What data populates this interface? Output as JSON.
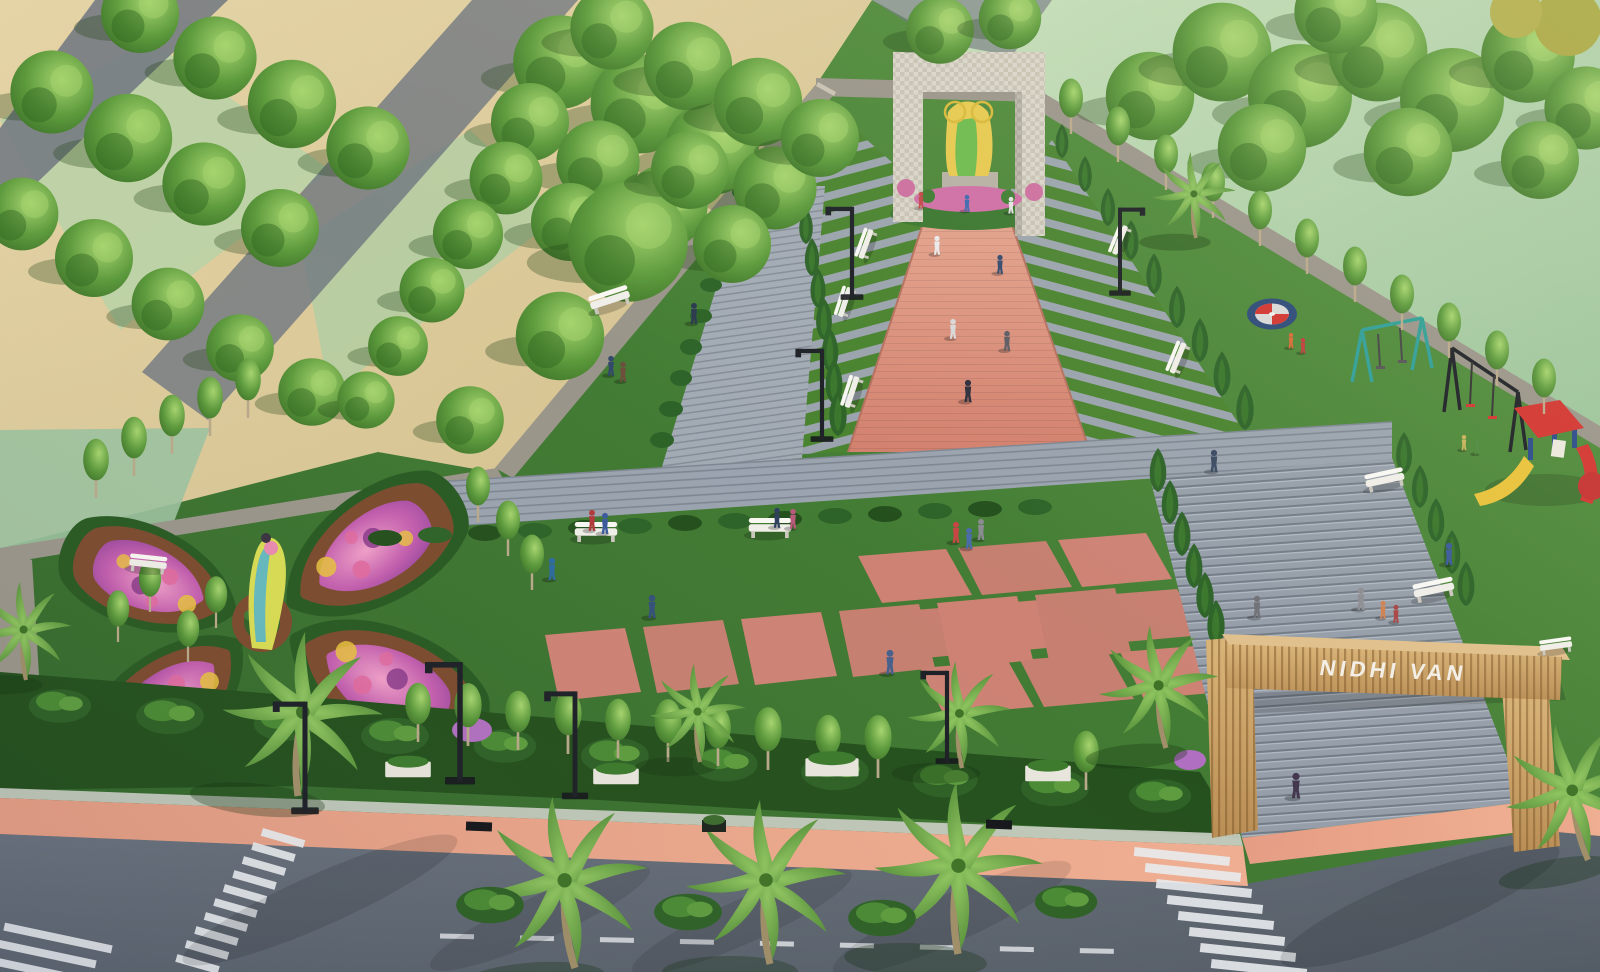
{
  "scene": {
    "title": "Nidhi Van — landscaped park aerial render",
    "gate_label": "NIDHI VAN"
  },
  "colors": {
    "grass": "#3f7c31",
    "lawn": "#b7d6ae",
    "sand": "#dbc998",
    "asphalt": "#6e7580",
    "wall": "#9a958a",
    "arch_stone": "#d8d4c8",
    "walkway_pink": "#dc9480",
    "plaza_tile": "#cd8274",
    "paver_gray": "#9aa3ae",
    "steps_gray": "#959ea9",
    "road": "#5d6670",
    "sidewalk_pink": "#e59d84",
    "curb": "#cdd0c8",
    "marking_white": "#e8ebee",
    "gate_wood": "#c9a066",
    "gate_wood_light": "#e0c08c",
    "gate_text": "#f3efe6",
    "hedge": "#2d6328",
    "hedge_dark": "#24501d",
    "tree_green": "#55923c",
    "tree_light": "#a6d46e",
    "palm_green": "#6faa45",
    "flower_purple": "#a855b8",
    "flower_pink": "#e06a9e",
    "flower_yellow": "#e8c23e",
    "soil": "#7c4b2e",
    "bench_white": "#efeee8",
    "planter_white": "#e8e6dc",
    "lamp_black": "#1d2026",
    "play_red": "#d23430",
    "play_blue": "#2a4a8a",
    "play_yellow": "#e8c23a",
    "swing_teal": "#2f9e96",
    "merry_blue": "#2c4a78",
    "statue_gold": "#e6c94f",
    "statue_teal": "#49b0d8",
    "statue_green": "#d8dc52"
  },
  "features": [
    "boundary-wall",
    "entrance-gate",
    "gate-steps",
    "zebra-crossings",
    "road",
    "sidewalk",
    "street-palms",
    "street-lamps",
    "hedge-rows",
    "flower-parterre",
    "parterre-sculpture",
    "central-palm",
    "stone-arch",
    "deity-statue",
    "ceremonial-walkway",
    "striped-paving",
    "paver-paths",
    "pink-plaza-grid",
    "stepping-squares",
    "benches",
    "planter-boxes",
    "playground",
    "merry-go-round",
    "swing-sets",
    "slide-structure",
    "lawns",
    "tree-clusters",
    "visitors"
  ]
}
